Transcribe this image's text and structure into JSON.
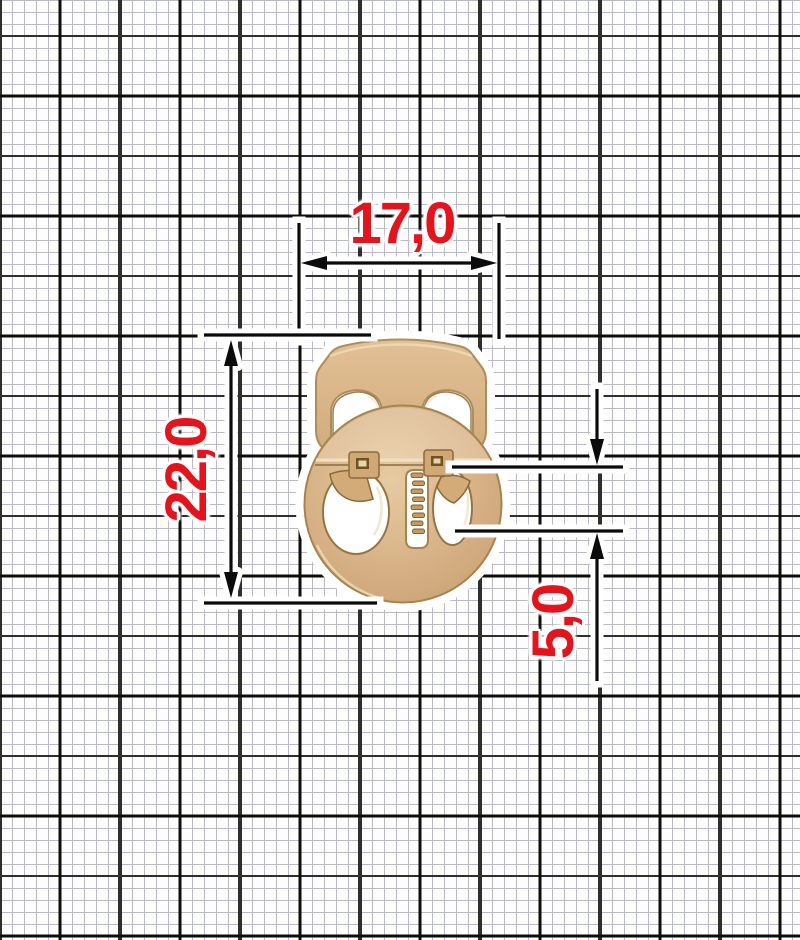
{
  "diagram": {
    "type": "dimensioned product drawing of a two-hole cord lock (stopper) on millimeter graph paper",
    "dimensions": {
      "width": "17,0",
      "height": "22,0",
      "slot": "5,0"
    },
    "colors": {
      "annotation_red": "#e8121b",
      "dimension_line_black": "#0b0b0b",
      "halo_white": "#ffffff",
      "gold_base": "#d8b388",
      "gold_shadow": "#a4854f",
      "gold_dark_rim": "#8a6838",
      "gold_highlight": "#f2e4c6",
      "paper": "#fdfdfc",
      "grid_fine": "#b9bac4",
      "grid_major": "#2e2e2e",
      "grid_heavy": "#0d0d0d"
    }
  }
}
